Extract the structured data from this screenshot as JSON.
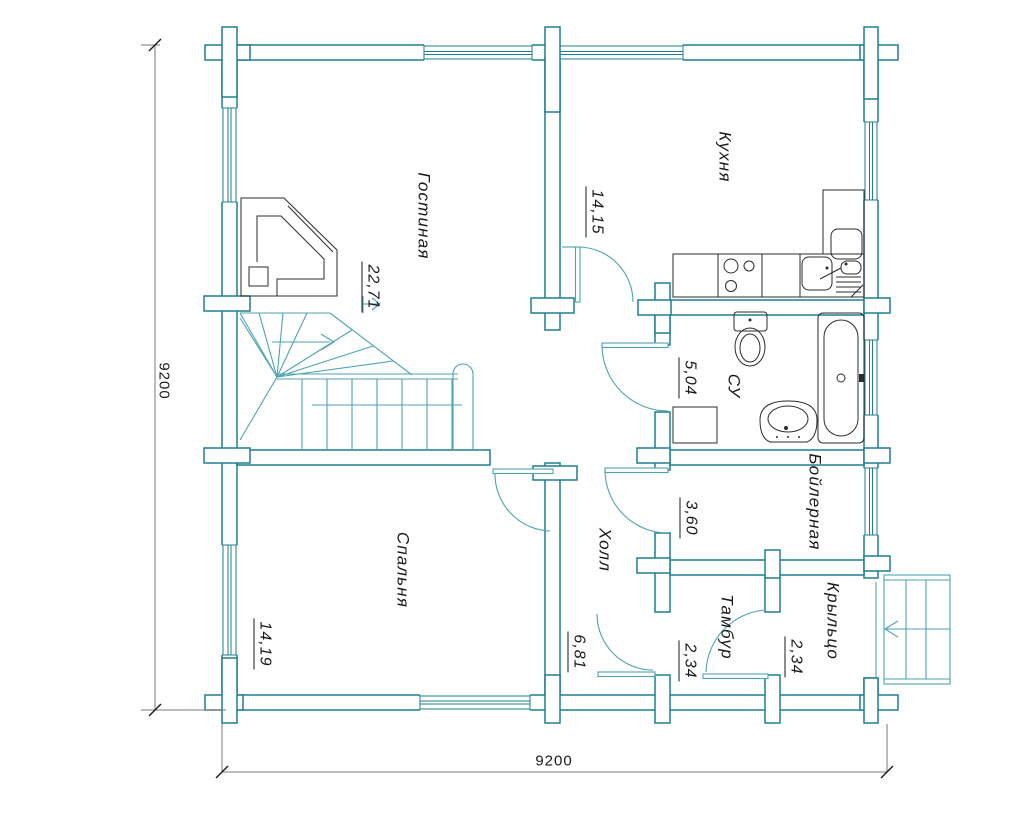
{
  "rooms": [
    {
      "name": "Гостиная",
      "area": "22,71"
    },
    {
      "name": "Кухня",
      "area": "14,15"
    },
    {
      "name": "СУ",
      "area": "5,04"
    },
    {
      "name": "Бойлерная",
      "area": "3,60"
    },
    {
      "name": "Холл",
      "area": "6,81"
    },
    {
      "name": "Спальня",
      "area": "14,19"
    },
    {
      "name": "Тамбур",
      "area": "2,34"
    },
    {
      "name": "Крыльцо",
      "area": "2,34"
    }
  ],
  "dimensions": {
    "left": "9200",
    "bottom": "9200"
  },
  "colors": {
    "wall": "#1e7f8f",
    "stairs_doors": "#4da3b2",
    "fixtures": "#2b2b2b",
    "dimension_lines": "#7a7a7a",
    "text": "#1a1a1a",
    "background": "#ffffff"
  }
}
